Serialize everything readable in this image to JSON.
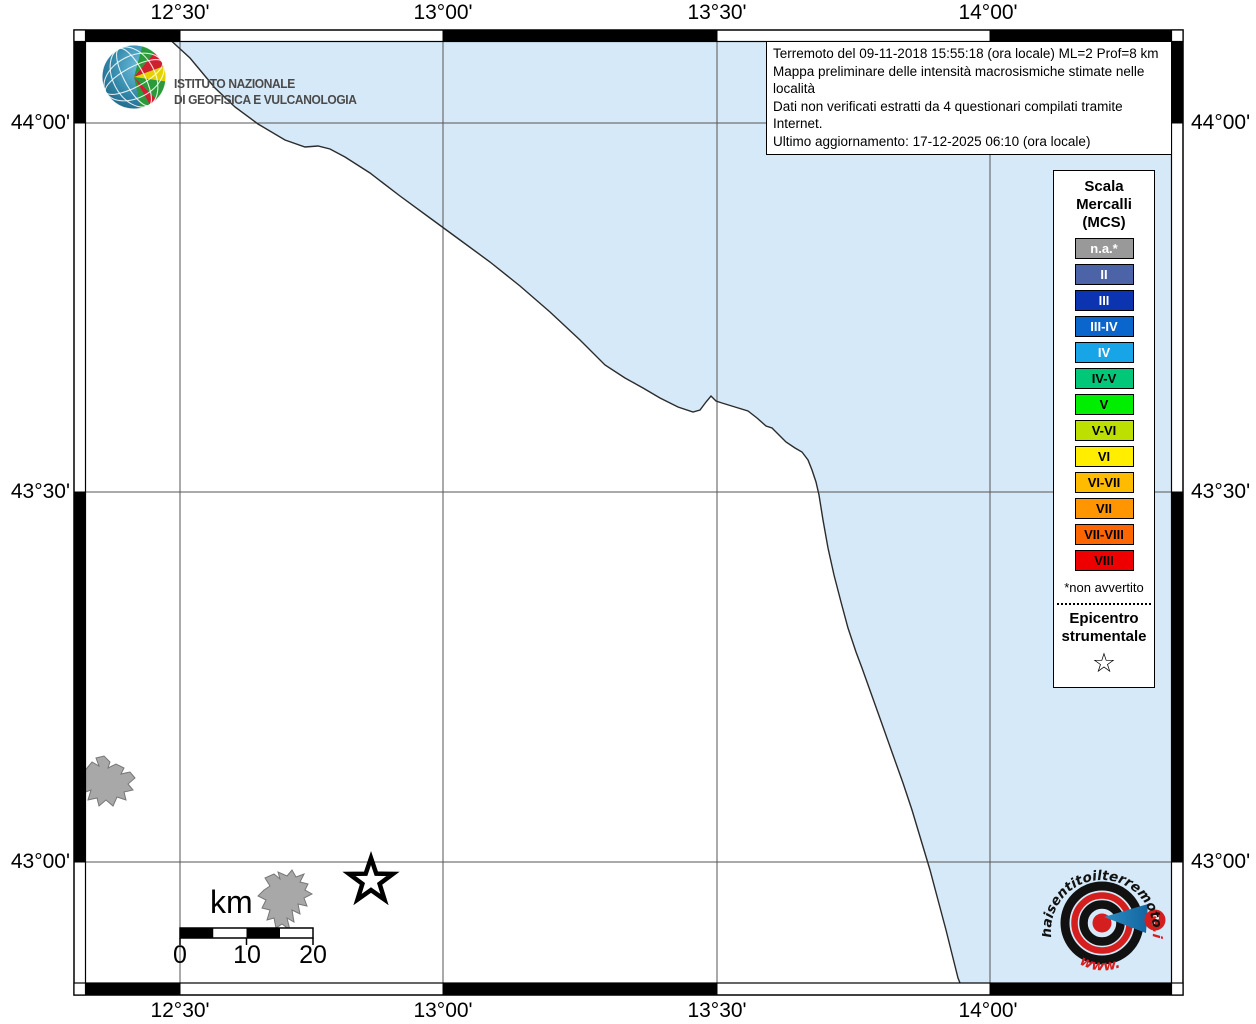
{
  "header": {
    "info_lines": [
      "Terremoto del 09-11-2018 15:55:18 (ora locale) ML=2 Prof=8 km",
      "Mappa preliminare delle intensità macrosismiche stimate nelle località",
      "Dati non verificati estratti da 4 questionari compilati tramite Internet.",
      "Ultimo aggiornamento: 17-12-2025 06:10 (ora locale)"
    ]
  },
  "ingv_logo": {
    "line1": "ISTITUTO NAZIONALE",
    "line2": "DI GEOFISICA E VULCANOLOGIA"
  },
  "axes": {
    "top": [
      "12°30'",
      "13°00'",
      "13°30'",
      "14°00'"
    ],
    "bottom": [
      "12°30'",
      "13°00'",
      "13°30'",
      "14°00'"
    ],
    "left": [
      "44°00'",
      "43°30'",
      "43°00'"
    ],
    "right": [
      "44°00'",
      "43°30'",
      "43°00'"
    ]
  },
  "legend": {
    "title_lines": [
      "Scala",
      "Mercalli",
      "(MCS)"
    ],
    "items": [
      {
        "label": "n.a.*",
        "color": "#999999",
        "text": "#ffffff"
      },
      {
        "label": "II",
        "color": "#4d63a8",
        "text": "#ffffff"
      },
      {
        "label": "III",
        "color": "#0c33b0",
        "text": "#ffffff"
      },
      {
        "label": "III-IV",
        "color": "#0a66cc",
        "text": "#ffffff"
      },
      {
        "label": "IV",
        "color": "#18a5e8",
        "text": "#ffffff"
      },
      {
        "label": "IV-V",
        "color": "#00c878",
        "text": "#000000"
      },
      {
        "label": "V",
        "color": "#00ee00",
        "text": "#000000"
      },
      {
        "label": "V-VI",
        "color": "#bee000",
        "text": "#000000"
      },
      {
        "label": "VI",
        "color": "#ffee00",
        "text": "#000000"
      },
      {
        "label": "VI-VII",
        "color": "#ffbb00",
        "text": "#000000"
      },
      {
        "label": "VII",
        "color": "#ff9500",
        "text": "#000000"
      },
      {
        "label": "VII-VIII",
        "color": "#ff6600",
        "text": "#000000"
      },
      {
        "label": "VIII",
        "color": "#ee0000",
        "text": "#000000"
      }
    ],
    "footnote": "*non avvertito",
    "epicenter_title_lines": [
      "Epicentro",
      "strumentale"
    ],
    "epicenter_symbol": "☆"
  },
  "scalebar": {
    "unit": "km",
    "ticks": [
      "0",
      "10",
      "20"
    ]
  },
  "watermark": {
    "arc_text": "haisentitoilterremoto",
    "tld": ".it",
    "www": "www.",
    "question_mark": "?"
  },
  "map": {
    "sea_color": "#d6e9f8",
    "land_color": "#ffffff",
    "urban_color": "#a8a8a8"
  }
}
